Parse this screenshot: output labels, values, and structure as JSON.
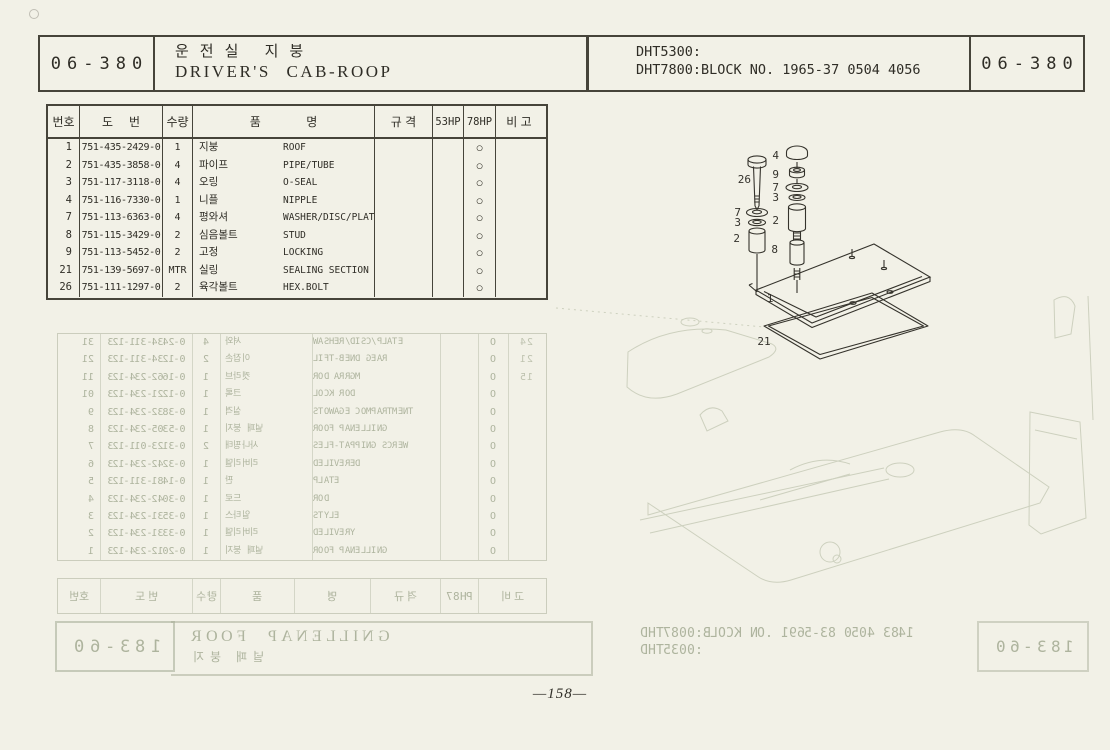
{
  "page": {
    "code": "06-380",
    "code_right": "06-380",
    "title_ko": "운전실  지붕",
    "title_en": "DRIVER'S  CAB-ROOP",
    "model_line1": "DHT5300:",
    "model_line2": "DHT7800:BLOCK NO. 1965-37 0504 4056",
    "page_number": "—158—"
  },
  "table": {
    "headers": {
      "no": "번호",
      "dwg_a": "도",
      "dwg_b": "번",
      "qty": "수량",
      "name_a": "품",
      "name_b": "명",
      "spec": "규  격",
      "hp53": "53HP",
      "hp78": "78HP",
      "remark": "비  고"
    },
    "rows": [
      {
        "no": "1",
        "part": "751-435-2429-0",
        "qty": "1",
        "ko": "지붕",
        "en": "ROOF",
        "mark": "○"
      },
      {
        "no": "2",
        "part": "751-435-3858-0",
        "qty": "4",
        "ko": "파이프",
        "en": "PIPE/TUBE",
        "mark": "○"
      },
      {
        "no": "3",
        "part": "751-117-3118-0",
        "qty": "4",
        "ko": "오링",
        "en": "O-SEAL",
        "mark": "○"
      },
      {
        "no": "4",
        "part": "751-116-7330-0",
        "qty": "1",
        "ko": "니플",
        "en": "NIPPLE",
        "mark": "○"
      },
      {
        "no": "7",
        "part": "751-113-6363-0",
        "qty": "4",
        "ko": "평와셔",
        "en": "WASHER/DISC/PLATE",
        "mark": "○"
      },
      {
        "no": "8",
        "part": "751-115-3429-0",
        "qty": "2",
        "ko": "심음볼트",
        "en": "STUD",
        "mark": "○"
      },
      {
        "no": "9",
        "part": "751-113-5452-0",
        "qty": "2",
        "ko": "고정",
        "en": "LOCKING",
        "mark": "○"
      },
      {
        "no": "21",
        "part": "751-139-5697-0",
        "qty": "MTR",
        "ko": "실링",
        "en": "SEALING SECTION",
        "mark": "○"
      },
      {
        "no": "26",
        "part": "751-111-1297-0",
        "qty": "2",
        "ko": "육각볼트",
        "en": "HEX.BOLT",
        "mark": "○"
      }
    ]
  },
  "diagram": {
    "callouts": [
      "4",
      "26",
      "9",
      "7",
      "3",
      "7",
      "3",
      "2",
      "2",
      "8",
      "1",
      "21"
    ]
  },
  "bleed_through": {
    "stamp_left": "06-381",
    "stamp_right": "06-381",
    "title_en": "ROOF PANELLING",
    "title_ko": "지붕 패널",
    "model_line1": "DHT7800:BLOCK NO. 1965-38 0504 3841",
    "model_line2": "DHT5300:",
    "footer_headers": [
      "번호",
      "도 번",
      "수량",
      "품",
      "명",
      "규 격",
      "78HP",
      "비 고"
    ],
    "rows": [
      {
        "no": "13",
        "part": "321-113-4342-0",
        "qty": "4",
        "ko": "와셔",
        "en": "WASHER/DISC/PLATE",
        "mark": "O",
        "no2": "42"
      },
      {
        "no": "12",
        "part": "321-113-4321-0",
        "qty": "2",
        "ko": "손잡이",
        "en": "LIFT-BEND GEAR",
        "mark": "O",
        "no2": "12"
      },
      {
        "no": "11",
        "part": "321-432-2661-0",
        "qty": "1",
        "ko": "브라켓",
        "en": "ROD ARRGM",
        "mark": "O",
        "no2": "51"
      },
      {
        "no": "10",
        "part": "321-432-1221-0",
        "qty": "1",
        "ko": "록크",
        "en": "LOCK ROD",
        "mark": "O",
        "no2": ""
      },
      {
        "no": "9",
        "part": "321-432-2383-0",
        "qty": "1",
        "ko": "격실",
        "en": "STOWAGE COMPARTMENT",
        "mark": "O",
        "no2": ""
      },
      {
        "no": "8",
        "part": "321-432-5035-0",
        "qty": "1",
        "ko": "지붕 패널",
        "en": "ROOF PANELLING",
        "mark": "O",
        "no2": ""
      },
      {
        "no": "7",
        "part": "321-110-3213-0",
        "qty": "2",
        "ko": "태핑나사",
        "en": "SELF-TAPPING SCREW",
        "mark": "O",
        "no2": ""
      },
      {
        "no": "6",
        "part": "321-432-2423-0",
        "qty": "1",
        "ko": "델리버리",
        "en": "DELIVERED",
        "mark": "O",
        "no2": ""
      },
      {
        "no": "5",
        "part": "321-113-1841-0",
        "qty": "1",
        "ko": "판",
        "en": "PLATE",
        "mark": "O",
        "no2": ""
      },
      {
        "no": "4",
        "part": "321-432-2403-0",
        "qty": "1",
        "ko": "로드",
        "en": "ROD",
        "mark": "O",
        "no2": ""
      },
      {
        "no": "3",
        "part": "321-432-1353-0",
        "qty": "1",
        "ko": "스타일",
        "en": "STYLE",
        "mark": "O",
        "no2": ""
      },
      {
        "no": "2",
        "part": "321-432-1333-0",
        "qty": "1",
        "ko": "델리버리",
        "en": "DELIVERY",
        "mark": "O",
        "no2": ""
      },
      {
        "no": "1",
        "part": "321-432-2102-0",
        "qty": "1",
        "ko": "지붕 패널",
        "en": "ROOF PANELLING",
        "mark": "O",
        "no2": ""
      }
    ]
  }
}
